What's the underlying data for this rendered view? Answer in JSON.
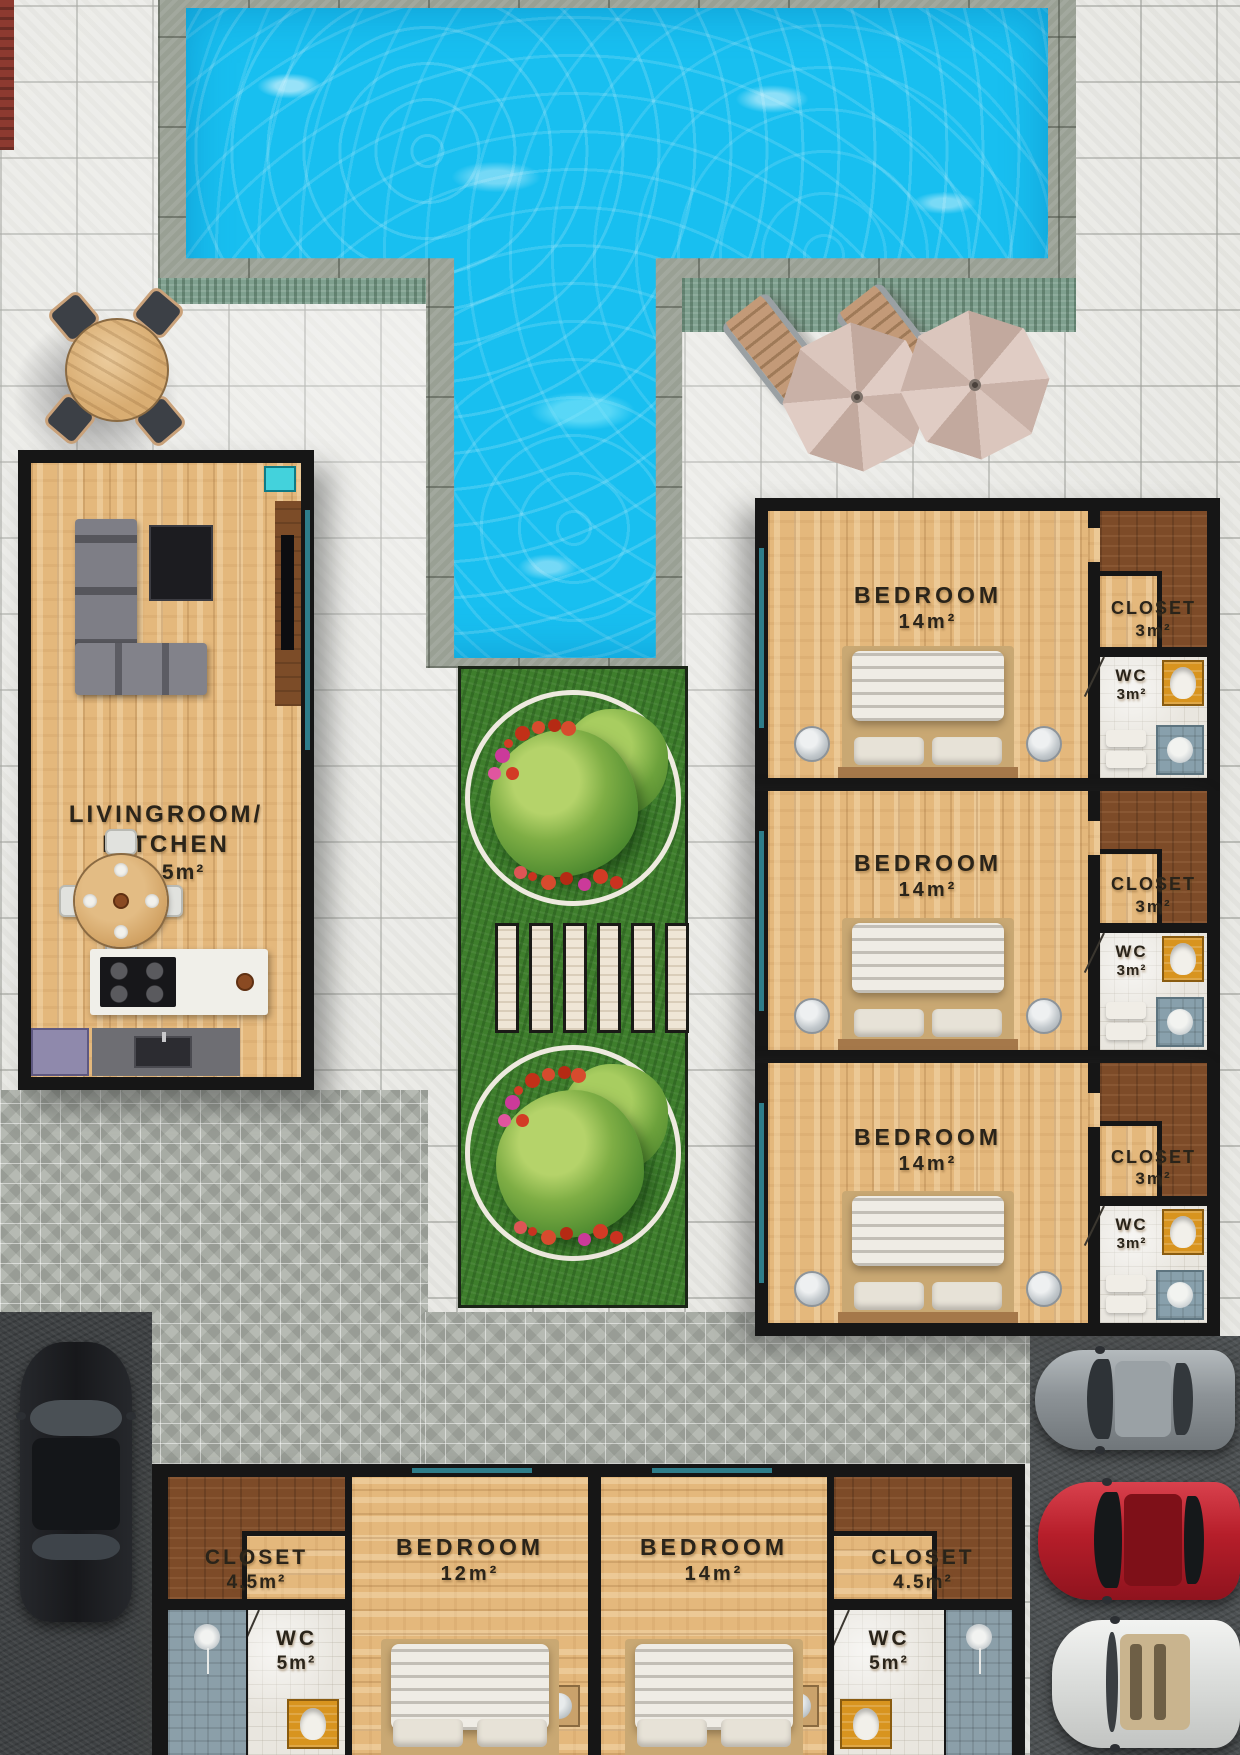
{
  "rooms": {
    "living": {
      "line1": "LIVINGROOM/",
      "line2": "KITCHEN",
      "area": "47.5m²"
    },
    "right_units": [
      {
        "bedroom": "BEDROOM",
        "bedroom_area": "14m²",
        "closet": "CLOSET",
        "closet_area": "3m²",
        "wc": "WC",
        "wc_area": "3m²"
      },
      {
        "bedroom": "BEDROOM",
        "bedroom_area": "14m²",
        "closet": "CLOSET",
        "closet_area": "3m²",
        "wc": "WC",
        "wc_area": "3m²"
      },
      {
        "bedroom": "BEDROOM",
        "bedroom_area": "14m²",
        "closet": "CLOSET",
        "closet_area": "3m²",
        "wc": "WC",
        "wc_area": "3m²"
      }
    ],
    "bottom_left": {
      "closet": "CLOSET",
      "closet_area": "4.5m²",
      "wc": "WC",
      "wc_area": "5m²",
      "bedroom": "BEDROOM",
      "bedroom_area": "12m²"
    },
    "bottom_right": {
      "bedroom": "BEDROOM",
      "bedroom_area": "14m²",
      "closet": "CLOSET",
      "closet_area": "4.5m²",
      "wc": "WC",
      "wc_area": "5m²"
    }
  },
  "palette": {
    "pool_water": "#18bff0",
    "pool_deck": "#99a094",
    "tile": "#e9e9e5",
    "grass": "#3e7e2c",
    "wood_floor": "#e4b87c",
    "closet_floor": "#7d4b28",
    "wall": "#161616",
    "wc_tile": "#e9e6df",
    "washer_orange": "#d8941f",
    "asphalt": "#4d5153",
    "car_black": "#1d1f21",
    "car_gray": "#9aa0a4",
    "car_red": "#c5202c",
    "car_white": "#e9eae8",
    "label_text": "#2a241a"
  }
}
